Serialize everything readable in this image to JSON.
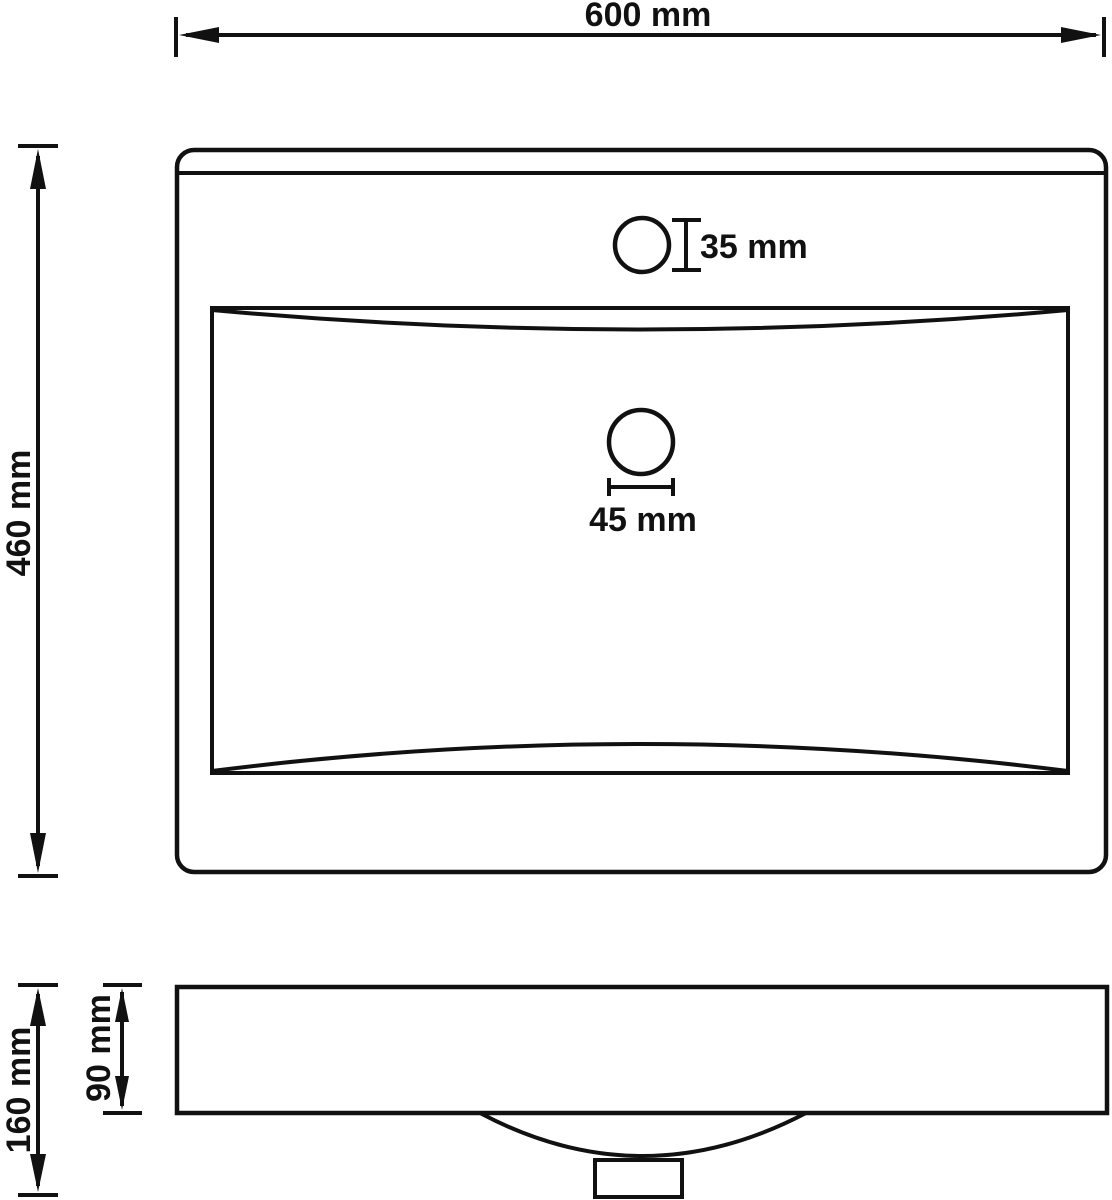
{
  "drawing": {
    "type": "technical-dimension-diagram",
    "subject": "washbasin-with-faucet-hole",
    "views": [
      "top-plan-view",
      "side-profile-view"
    ],
    "background_color": "#ffffff",
    "line_color": "#111111"
  },
  "labels": {
    "top_width": "600 mm",
    "left_height": "460 mm",
    "faucet_hole": "35 mm",
    "drain_hole": "45 mm",
    "total_height": "160 mm",
    "basin_depth": "90 mm"
  },
  "dimensions_mm": {
    "outer_width": 600,
    "outer_depth": 460,
    "faucet_hole_diameter": 35,
    "drain_hole_diameter": 45,
    "total_height": 160,
    "basin_inner_depth": 90
  }
}
